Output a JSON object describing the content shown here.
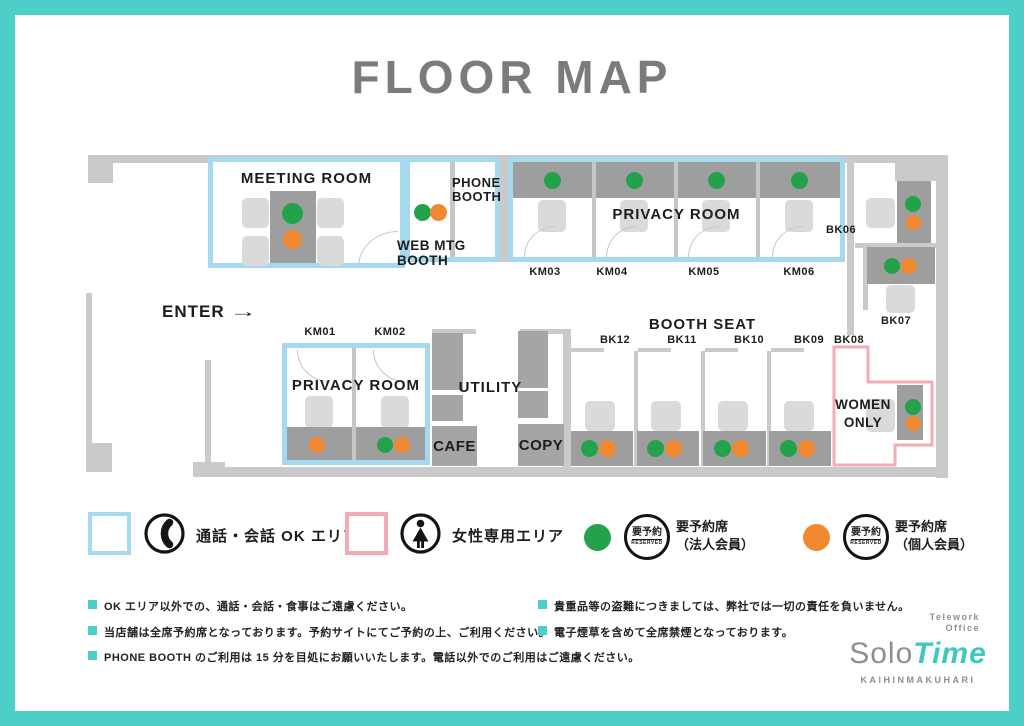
{
  "title": "FLOOR MAP",
  "map": {
    "enter": "ENTER",
    "enter_arrow": "→",
    "meeting_room": "MEETING ROOM",
    "web_mtg_booth": "WEB MTG BOOTH",
    "phone_booth": "PHONE BOOTH",
    "privacy_room_top": {
      "label": "PRIVACY ROOM",
      "units": [
        "KM03",
        "KM04",
        "KM05",
        "KM06"
      ]
    },
    "privacy_room_bottom": {
      "label": "PRIVACY ROOM",
      "units": [
        "KM01",
        "KM02"
      ]
    },
    "utility": "UTILITY",
    "cafe": "CAFE",
    "copy": "COPY",
    "booth_seat": {
      "label": "BOOTH SEAT",
      "units": [
        "BK12",
        "BK11",
        "BK10",
        "BK09",
        "BK08"
      ]
    },
    "side_booths": {
      "bk06": "BK06",
      "bk07": "BK07"
    },
    "women_only": "WOMEN ONLY"
  },
  "legend": {
    "call_ok_label": "通話・会話 OK エリア",
    "women_area_label": "女性専用エリア",
    "reserved_badge": {
      "top": "要予約",
      "bottom": "RESERVED"
    },
    "corporate": {
      "line1": "要予約席",
      "line2": "（法人会員）"
    },
    "individual": {
      "line1": "要予約席",
      "line2": "（個人会員）"
    }
  },
  "notes": {
    "left": [
      "OK エリア以外での、通話・会話・食事はご遠慮ください。",
      "当店舗は全席予約席となっております。予約サイトにてご予約の上、ご利用ください。",
      "PHONE BOOTH のご利用は 15 分を目処にお願いいたします。電話以外でのご利用はご遠慮ください。"
    ],
    "right": [
      "貴重品等の盗難につきましては、弊社では一切の責任を負いません。",
      "電子煙草を含めて全席禁煙となっております。"
    ]
  },
  "logo": {
    "tagline_line1": "Telework",
    "tagline_line2": "Office",
    "brand_solo": "Solo",
    "brand_time": "Time",
    "location": "KAIHINMAKUHARI"
  },
  "colors": {
    "frame_teal": "#4dcec7",
    "call_ok_blue": "#a6d9ed",
    "women_only_pink": "#f2abb7",
    "corporate_green": "#24a24b",
    "individual_orange": "#f0882f",
    "wall_gray": "#cacaca",
    "desk_gray": "#9e9e9e"
  }
}
